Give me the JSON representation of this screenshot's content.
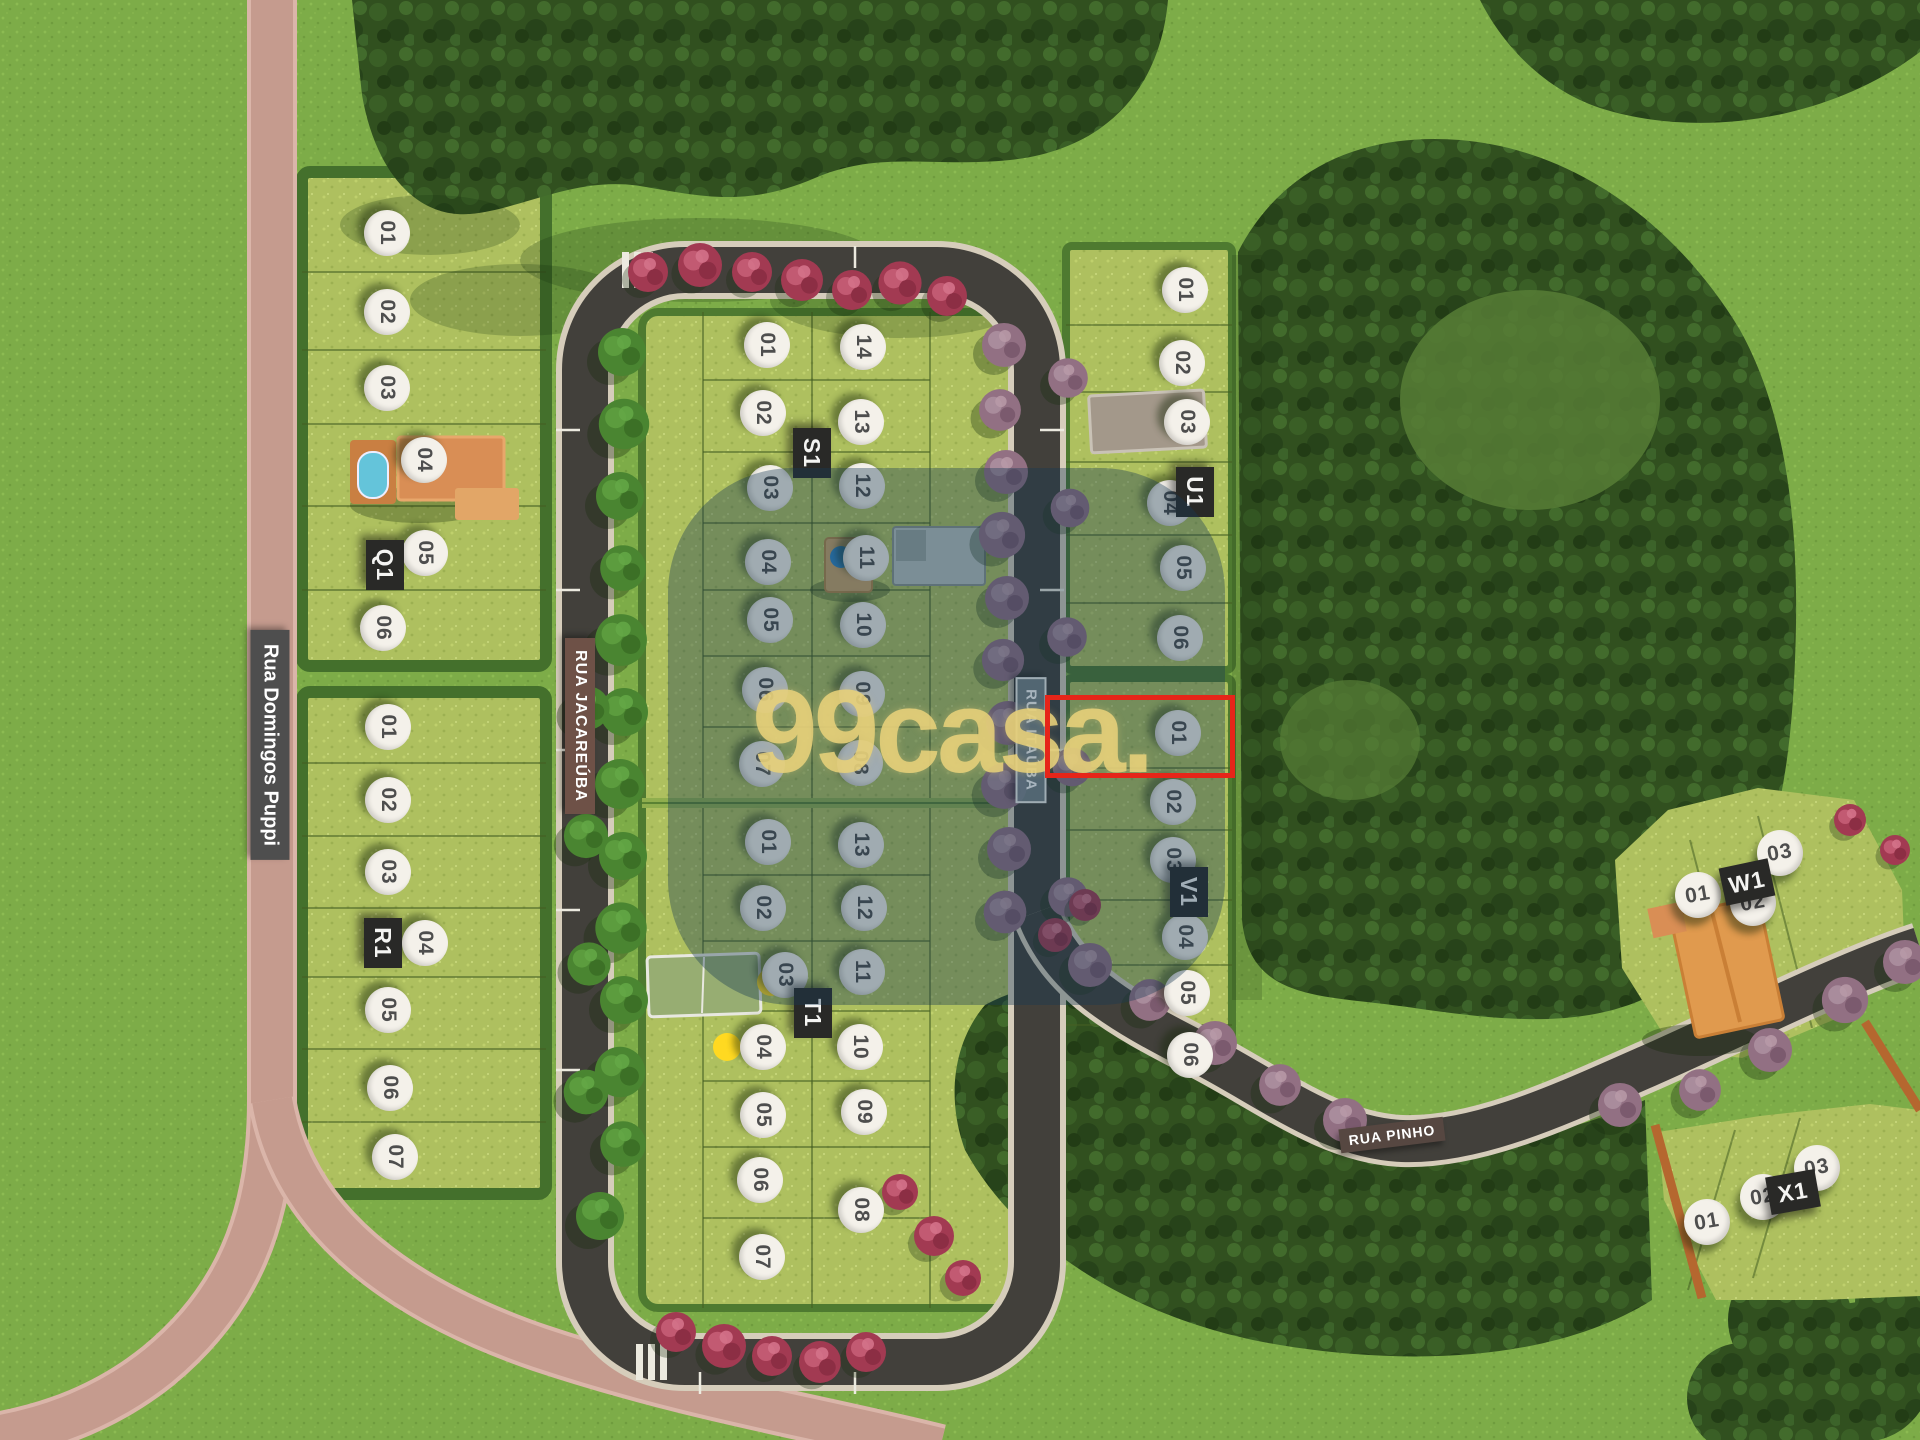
{
  "map": {
    "watermark": {
      "text": "99casa."
    },
    "highlighted_lot": {
      "block": "V1",
      "lot": "01"
    },
    "streets": [
      {
        "name": "Rua Domingos Puppi",
        "style": "dark",
        "x": 270,
        "y": 745,
        "rotation": 90
      },
      {
        "name": "RUA JACAREÚBA",
        "style": "brown",
        "x": 580,
        "y": 726,
        "rotation": 90
      },
      {
        "name": "RUA ITAÚBA",
        "style": "glass",
        "x": 1031,
        "y": 740,
        "rotation": 90
      },
      {
        "name": "RUA PINHO",
        "style": "pinho",
        "x": 1392,
        "y": 1135,
        "rotation": -7
      }
    ],
    "blocks": [
      {
        "id": "Q1",
        "lot_rotation": 90,
        "label": {
          "x": 385,
          "y": 565,
          "rotation": 90
        },
        "lots": [
          {
            "n": "01",
            "x": 387,
            "y": 233
          },
          {
            "n": "02",
            "x": 387,
            "y": 312
          },
          {
            "n": "03",
            "x": 387,
            "y": 388
          },
          {
            "n": "04",
            "x": 424,
            "y": 460
          },
          {
            "n": "05",
            "x": 425,
            "y": 553
          },
          {
            "n": "06",
            "x": 383,
            "y": 628
          }
        ]
      },
      {
        "id": "R1",
        "lot_rotation": 90,
        "label": {
          "x": 383,
          "y": 943,
          "rotation": 90
        },
        "lots": [
          {
            "n": "01",
            "x": 388,
            "y": 727
          },
          {
            "n": "02",
            "x": 388,
            "y": 800
          },
          {
            "n": "03",
            "x": 388,
            "y": 872
          },
          {
            "n": "04",
            "x": 425,
            "y": 943
          },
          {
            "n": "05",
            "x": 388,
            "y": 1010
          },
          {
            "n": "06",
            "x": 390,
            "y": 1088
          },
          {
            "n": "07",
            "x": 395,
            "y": 1157
          }
        ]
      },
      {
        "id": "S1",
        "lot_rotation": 90,
        "label": {
          "x": 812,
          "y": 453,
          "rotation": 90
        },
        "lots": [
          {
            "n": "01",
            "x": 767,
            "y": 345
          },
          {
            "n": "02",
            "x": 763,
            "y": 413
          },
          {
            "n": "03",
            "x": 770,
            "y": 488
          },
          {
            "n": "04",
            "x": 768,
            "y": 562
          },
          {
            "n": "05",
            "x": 770,
            "y": 620
          },
          {
            "n": "06",
            "x": 765,
            "y": 690
          },
          {
            "n": "07",
            "x": 762,
            "y": 764
          },
          {
            "n": "08",
            "x": 860,
            "y": 763
          },
          {
            "n": "09",
            "x": 862,
            "y": 694
          },
          {
            "n": "10",
            "x": 863,
            "y": 625
          },
          {
            "n": "11",
            "x": 866,
            "y": 558
          },
          {
            "n": "12",
            "x": 862,
            "y": 486
          },
          {
            "n": "13",
            "x": 861,
            "y": 422
          },
          {
            "n": "14",
            "x": 863,
            "y": 347
          }
        ]
      },
      {
        "id": "T1",
        "lot_rotation": 90,
        "label": {
          "x": 813,
          "y": 1013,
          "rotation": 90
        },
        "lots": [
          {
            "n": "01",
            "x": 768,
            "y": 842
          },
          {
            "n": "02",
            "x": 763,
            "y": 908
          },
          {
            "n": "03",
            "x": 785,
            "y": 975
          },
          {
            "n": "04",
            "x": 763,
            "y": 1047
          },
          {
            "n": "05",
            "x": 763,
            "y": 1115
          },
          {
            "n": "06",
            "x": 760,
            "y": 1180
          },
          {
            "n": "07",
            "x": 762,
            "y": 1257
          },
          {
            "n": "08",
            "x": 861,
            "y": 1210
          },
          {
            "n": "09",
            "x": 864,
            "y": 1112
          },
          {
            "n": "10",
            "x": 860,
            "y": 1047
          },
          {
            "n": "11",
            "x": 862,
            "y": 972
          },
          {
            "n": "12",
            "x": 864,
            "y": 908
          },
          {
            "n": "13",
            "x": 861,
            "y": 845
          }
        ]
      },
      {
        "id": "U1",
        "lot_rotation": 90,
        "label": {
          "x": 1195,
          "y": 492,
          "rotation": 90
        },
        "lots": [
          {
            "n": "01",
            "x": 1185,
            "y": 290
          },
          {
            "n": "02",
            "x": 1182,
            "y": 363
          },
          {
            "n": "03",
            "x": 1187,
            "y": 422
          },
          {
            "n": "04",
            "x": 1170,
            "y": 503
          },
          {
            "n": "05",
            "x": 1183,
            "y": 568
          },
          {
            "n": "06",
            "x": 1180,
            "y": 638
          }
        ]
      },
      {
        "id": "V1",
        "lot_rotation": 90,
        "label": {
          "x": 1189,
          "y": 892,
          "rotation": 90
        },
        "lots": [
          {
            "n": "01",
            "x": 1178,
            "y": 733
          },
          {
            "n": "02",
            "x": 1173,
            "y": 802
          },
          {
            "n": "03",
            "x": 1173,
            "y": 860
          },
          {
            "n": "04",
            "x": 1185,
            "y": 937
          },
          {
            "n": "05",
            "x": 1187,
            "y": 993
          },
          {
            "n": "06",
            "x": 1190,
            "y": 1055
          }
        ]
      },
      {
        "id": "W1",
        "lot_rotation": -10,
        "label": {
          "x": 1747,
          "y": 882,
          "rotation": -12
        },
        "lots": [
          {
            "n": "01",
            "x": 1698,
            "y": 895
          },
          {
            "n": "02",
            "x": 1753,
            "y": 903
          },
          {
            "n": "03",
            "x": 1780,
            "y": 853
          }
        ]
      },
      {
        "id": "X1",
        "lot_rotation": -10,
        "label": {
          "x": 1793,
          "y": 1192,
          "rotation": -10
        },
        "lots": [
          {
            "n": "01",
            "x": 1707,
            "y": 1222
          },
          {
            "n": "02",
            "x": 1763,
            "y": 1197
          },
          {
            "n": "03",
            "x": 1817,
            "y": 1168
          }
        ]
      }
    ]
  },
  "palette": {
    "grass": "#7dac48",
    "block": "#aec05f",
    "hedge": "#44702c",
    "forest": "#31501f",
    "road": "#42403b",
    "curb": "#d6cdbb",
    "pink_road": "#c59b8e",
    "pink_road_edge": "#dab5a9",
    "overlay": "rgba(24,59,84,0.38)",
    "red": "#e62519",
    "watermark": "rgba(231,208,122,0.88)",
    "badge_bg": "#f4f1ea",
    "badge_text": "#4e4e4e",
    "label_bg": "#292927"
  }
}
